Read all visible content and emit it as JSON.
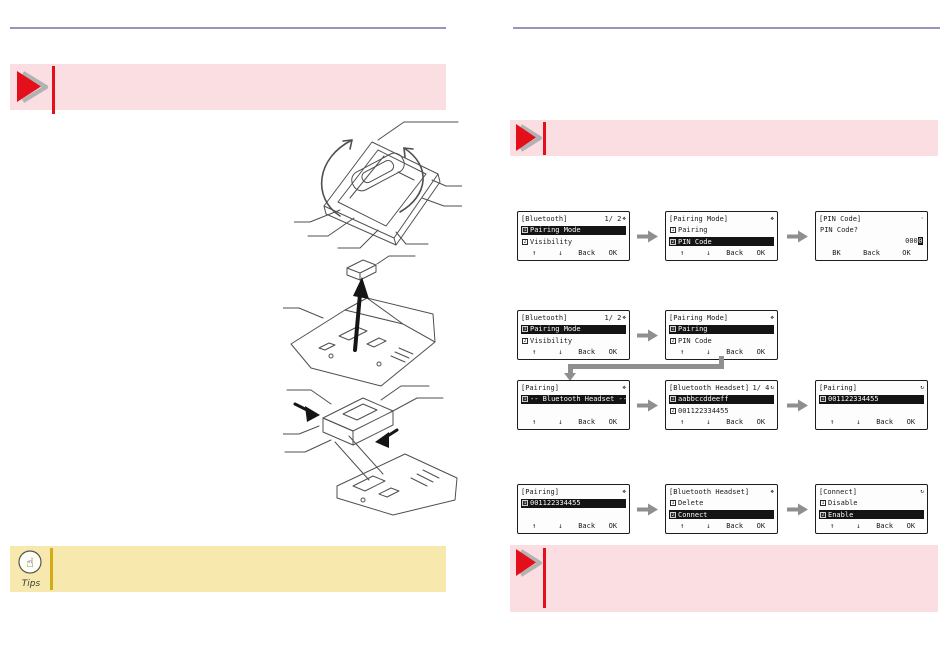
{
  "tips": {
    "label": "Tips"
  },
  "icons": {
    "tips_hand": "☝",
    "nav_cluster": "❖",
    "sync": "↻",
    "signal_dot": "·",
    "note_arrow": "red-triangle-arrow",
    "flow_arrow": "right-block-arrow"
  },
  "colors": {
    "accent_red": "#e3101b",
    "note_pink_bg": "#fbdee2",
    "tips_yellow_bg": "#f7e9ad",
    "tips_accent": "#d1ac14",
    "rule_purple": "#9795ba",
    "arrow_gray": "#8f8f8f",
    "lcd_border": "#1c1c1c"
  },
  "screens": [
    {
      "title": "[Bluetooth]",
      "page": "1/ 2",
      "icon": "❖",
      "items": [
        {
          "num": "1",
          "label": "Pairing Mode",
          "highlighted": true
        },
        {
          "num": "2",
          "label": "Visibility",
          "highlighted": false
        }
      ],
      "softkeys": [
        "↑",
        "↓",
        "Back",
        "OK"
      ]
    },
    {
      "title": "[Pairing Mode]",
      "page": "",
      "icon": "❖",
      "items": [
        {
          "num": "1",
          "label": "Pairing",
          "highlighted": false
        },
        {
          "num": "2",
          "label": "PIN Code",
          "highlighted": true
        }
      ],
      "softkeys": [
        "↑",
        "↓",
        "Back",
        "OK"
      ]
    },
    {
      "title": "[PIN Code]",
      "page": "",
      "icon": "·",
      "prompt": "PIN Code?",
      "value": "000",
      "cursor": "0",
      "softkeys": [
        "BK",
        "Back",
        "OK"
      ]
    },
    {
      "title": "[Bluetooth]",
      "page": "1/ 2",
      "icon": "❖",
      "items": [
        {
          "num": "1",
          "label": "Pairing Mode",
          "highlighted": true
        },
        {
          "num": "2",
          "label": "Visibility",
          "highlighted": false
        }
      ],
      "softkeys": [
        "↑",
        "↓",
        "Back",
        "OK"
      ]
    },
    {
      "title": "[Pairing Mode]",
      "page": "",
      "icon": "❖",
      "items": [
        {
          "num": "1",
          "label": "Pairing",
          "highlighted": true
        },
        {
          "num": "2",
          "label": "PIN Code",
          "highlighted": false
        }
      ],
      "softkeys": [
        "↑",
        "↓",
        "Back",
        "OK"
      ]
    },
    {
      "title": "[Pairing]",
      "page": "",
      "icon": "❖",
      "items": [
        {
          "num": "1",
          "label": "-- Bluetooth Headset --",
          "highlighted": true
        }
      ],
      "softkeys": [
        "↑",
        "↓",
        "Back",
        "OK"
      ]
    },
    {
      "title": "[Bluetooth Headset]",
      "page": "1/ 4",
      "icon": "↻",
      "items": [
        {
          "num": "1",
          "label": "aabbccddeeff",
          "highlighted": true
        },
        {
          "num": "2",
          "label": "001122334455",
          "highlighted": false
        }
      ],
      "softkeys": [
        "↑",
        "↓",
        "Back",
        "OK"
      ]
    },
    {
      "title": "[Pairing]",
      "page": "",
      "icon": "↻",
      "items": [
        {
          "num": "1",
          "label": "001122334455",
          "highlighted": true
        }
      ],
      "softkeys": [
        "↑",
        "↓",
        "Back",
        "OK"
      ]
    },
    {
      "title": "[Pairing]",
      "page": "",
      "icon": "❖",
      "items": [
        {
          "num": "1",
          "label": "001122334455",
          "highlighted": true
        }
      ],
      "softkeys": [
        "↑",
        "↓",
        "Back",
        "OK"
      ]
    },
    {
      "title": "[Bluetooth Headset]",
      "page": "",
      "icon": "❖",
      "items": [
        {
          "num": "1",
          "label": "Delete",
          "highlighted": false
        },
        {
          "num": "2",
          "label": "Connect",
          "highlighted": true
        }
      ],
      "softkeys": [
        "↑",
        "↓",
        "Back",
        "OK"
      ]
    },
    {
      "title": "[Connect]",
      "page": "",
      "icon": "↻",
      "items": [
        {
          "num": "1",
          "label": "Disable",
          "highlighted": false
        },
        {
          "num": "2",
          "label": "Enable",
          "highlighted": true
        }
      ],
      "softkeys": [
        "↑",
        "↓",
        "Back",
        "OK"
      ]
    }
  ]
}
